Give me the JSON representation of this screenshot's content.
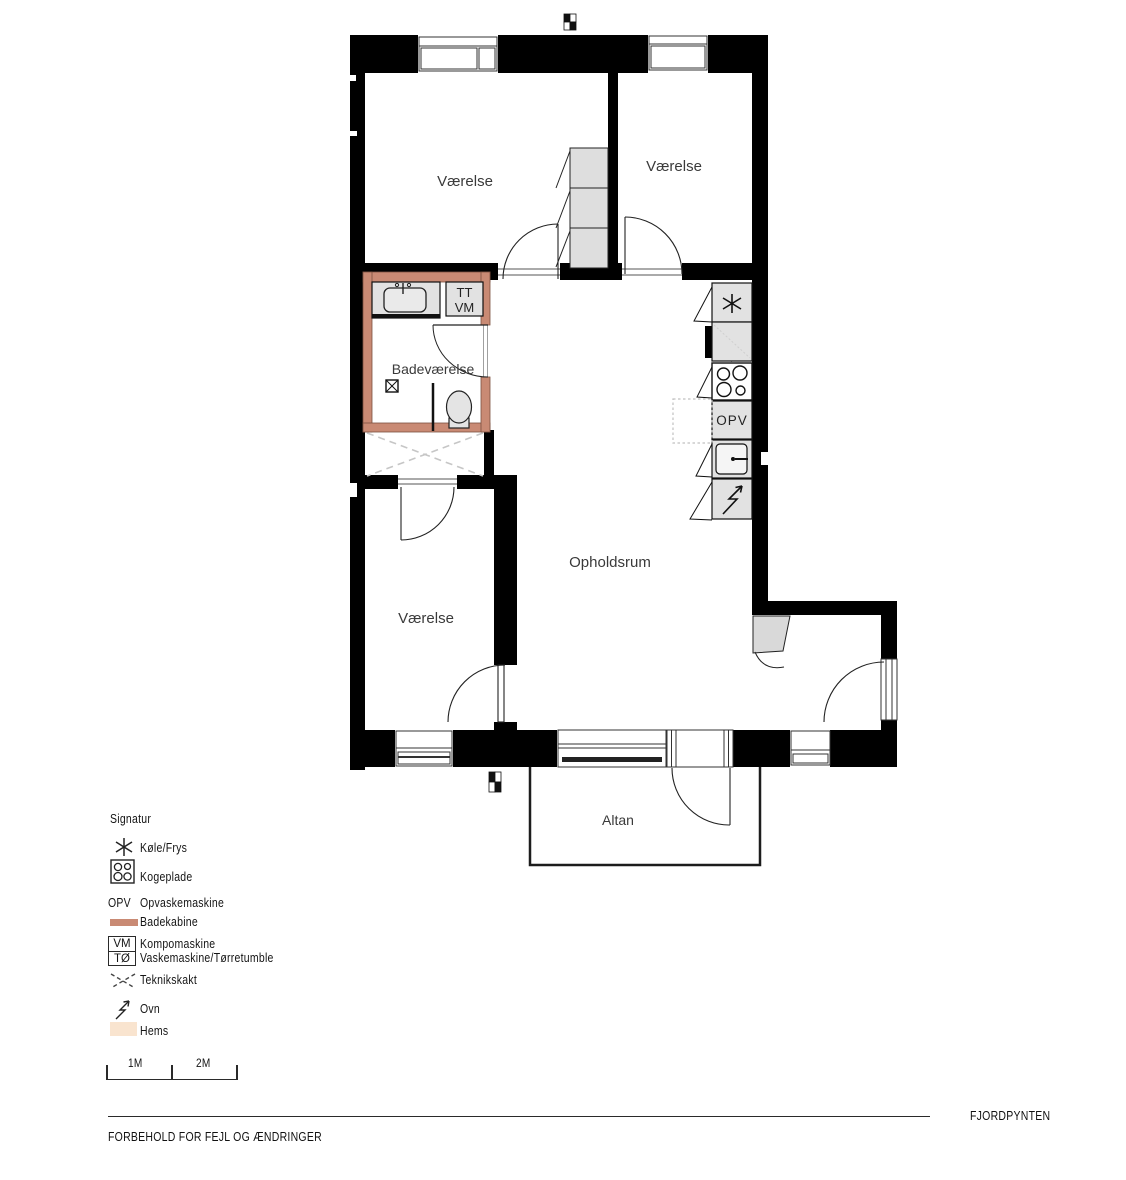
{
  "plan": {
    "rooms": {
      "room_top_left": "Værelse",
      "room_top_right": "Værelse",
      "room_bottom_left": "Værelse",
      "bathroom": "Badeværelse",
      "living_room": "Opholdsrum",
      "balcony": "Altan"
    },
    "labels": {
      "dishwasher": "OPV",
      "washer_unit_line1": "TT",
      "washer_unit_line2": "VM"
    }
  },
  "legend": {
    "title": "Signatur",
    "items": {
      "fridge": "Køle/Frys",
      "hob": "Kogeplade",
      "dishwasher_abbr": "OPV",
      "dishwasher": "Opvaskemaskine",
      "shower_cabin": "Badekabine",
      "washer_box_line1": "VM",
      "washer_box_line2": "TØ",
      "washer_line1": "Kompomaskine",
      "washer_line2": "Vaskemaskine/Tørretumble",
      "duct": "Teknikskakt",
      "oven": "Ovn",
      "loft": "Hems"
    },
    "scale": {
      "label_1m": "1M",
      "label_2m": "2M"
    }
  },
  "footer": {
    "disclaimer": "FORBEHOLD FOR FEJL OG ÆNDRINGER",
    "project_name": "FJORDPYNTEN"
  },
  "colors": {
    "wall": "#000000",
    "shower_cabin": "#c98a74",
    "loft": "#f9e4cf",
    "fixture": "#e2e2e2"
  }
}
